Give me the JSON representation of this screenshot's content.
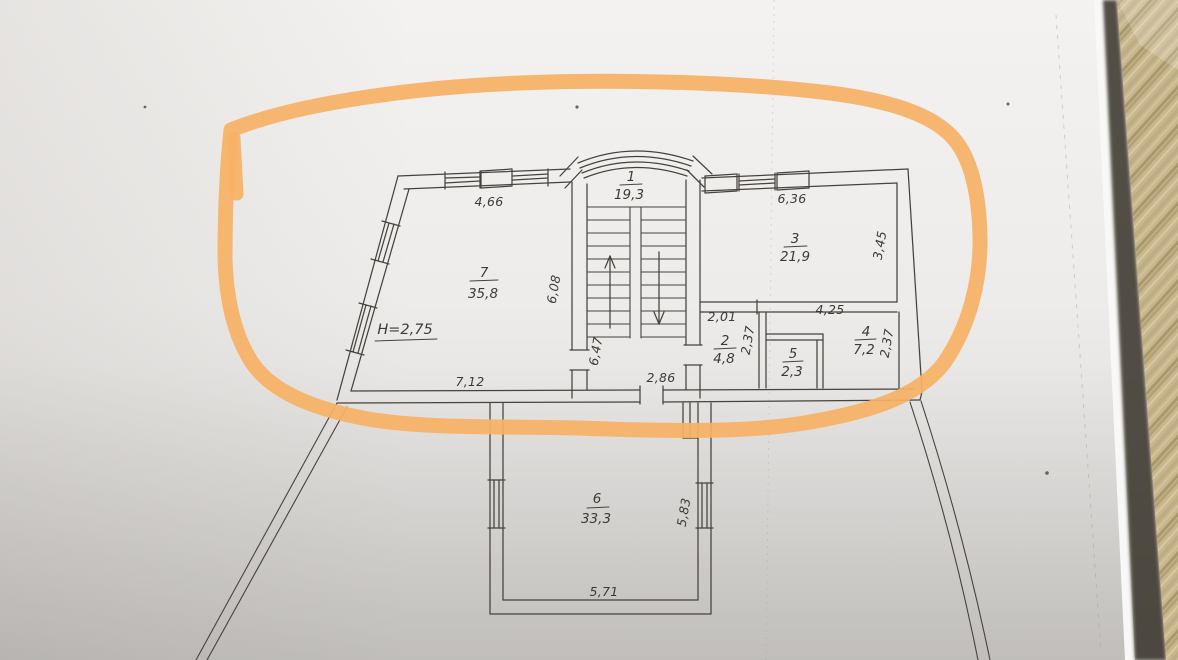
{
  "floor_plan": {
    "rooms": [
      {
        "number": "1",
        "area": "19,3"
      },
      {
        "number": "2",
        "area": "4,8"
      },
      {
        "number": "3",
        "area": "21,9"
      },
      {
        "number": "4",
        "area": "7,2"
      },
      {
        "number": "5",
        "area": "2,3"
      },
      {
        "number": "6",
        "area": "33,3"
      },
      {
        "number": "7",
        "area": "35,8"
      }
    ],
    "ceiling_height": "H=2,75",
    "dims": {
      "room7_top": "4,66",
      "room7_bottom": "7,12",
      "room7_right": "6,08",
      "room3_top": "6,36",
      "room3_right": "3,45",
      "room2_top": "2,01",
      "room2_right": "2,37",
      "room4_top": "4,25",
      "room4_right": "2,37",
      "stair_hall_left": "6,47",
      "hall_bottom": "2,86",
      "room6_right": "5,83",
      "room6_bottom": "5,71"
    },
    "colors": {
      "ink": "#45413d",
      "marker": "#f6b166",
      "paper": "#efeeec",
      "wood": "#c6b48b"
    }
  }
}
